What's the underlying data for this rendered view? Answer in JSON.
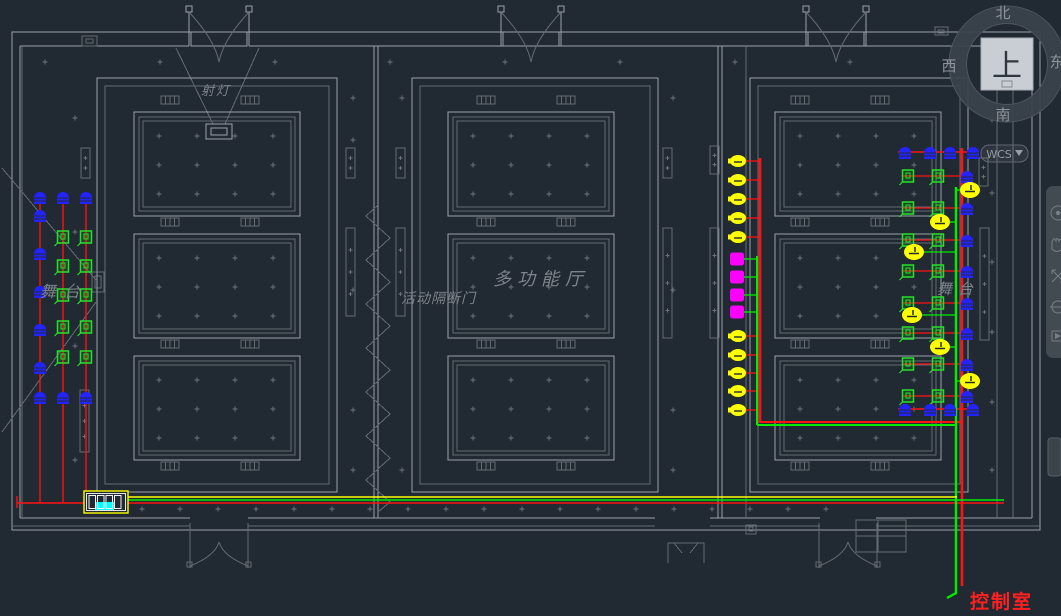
{
  "colors": {
    "background": "#212933",
    "line": "#9aa1a8",
    "line_dim": "#646b72",
    "text": "#7d848b",
    "wire_red": "#ff1212",
    "wire_green": "#00ef00",
    "wire_yellow": "#ffff00",
    "device_blue": "#2323ff",
    "device_green": "#28e028",
    "device_yellow": "#ffff00",
    "device_magenta": "#ff00ff",
    "rack_cyan": "#00ffff",
    "control_room_text": "#ff2020"
  },
  "viewcube": {
    "north": "北",
    "south": "南",
    "west": "西",
    "east": "东",
    "top": "上",
    "wcs_label": "WCS"
  },
  "drawing": {
    "labels": [
      {
        "id": "spotlight",
        "text": "射灯",
        "x": 201,
        "y": 95,
        "size": 13,
        "ls": 2
      },
      {
        "id": "stage-left",
        "text": "舞台",
        "x": 40,
        "y": 297,
        "size": 16,
        "ls": 8
      },
      {
        "id": "partition-door",
        "text": "活动隔断门",
        "x": 401,
        "y": 303,
        "size": 14,
        "ls": 1
      },
      {
        "id": "hall",
        "text": "多功能厅",
        "x": 493,
        "y": 285,
        "size": 18,
        "ls": 6
      },
      {
        "id": "stage-right",
        "text": "舞台",
        "x": 937,
        "y": 294,
        "size": 15,
        "ls": 6
      },
      {
        "id": "control-room",
        "text": "控制室",
        "x": 970,
        "y": 608,
        "size": 19,
        "ls": 2,
        "color": "#ff2020",
        "bold": true
      }
    ],
    "rack": {
      "x": 84,
      "y": 491,
      "w": 44,
      "h": 22
    },
    "devices": [
      {
        "t": "blue",
        "x": 40,
        "y": 197
      },
      {
        "t": "blue",
        "x": 63,
        "y": 197
      },
      {
        "t": "blue",
        "x": 86,
        "y": 197
      },
      {
        "t": "blue",
        "x": 40,
        "y": 215
      },
      {
        "t": "blue",
        "x": 40,
        "y": 253
      },
      {
        "t": "blue",
        "x": 40,
        "y": 291
      },
      {
        "t": "blue",
        "x": 40,
        "y": 329
      },
      {
        "t": "blue",
        "x": 40,
        "y": 367
      },
      {
        "t": "blue",
        "x": 40,
        "y": 397
      },
      {
        "t": "blue",
        "x": 63,
        "y": 397
      },
      {
        "t": "blue",
        "x": 86,
        "y": 397
      },
      {
        "t": "green",
        "x": 63,
        "y": 237
      },
      {
        "t": "green",
        "x": 86,
        "y": 237
      },
      {
        "t": "green",
        "x": 63,
        "y": 266
      },
      {
        "t": "green",
        "x": 86,
        "y": 266
      },
      {
        "t": "green",
        "x": 63,
        "y": 295
      },
      {
        "t": "green",
        "x": 86,
        "y": 295
      },
      {
        "t": "green",
        "x": 63,
        "y": 327
      },
      {
        "t": "green",
        "x": 86,
        "y": 327
      },
      {
        "t": "green",
        "x": 63,
        "y": 357
      },
      {
        "t": "green",
        "x": 86,
        "y": 357
      },
      {
        "t": "yellow",
        "x": 738,
        "y": 161
      },
      {
        "t": "yellow",
        "x": 738,
        "y": 180
      },
      {
        "t": "yellow",
        "x": 738,
        "y": 199
      },
      {
        "t": "yellow",
        "x": 738,
        "y": 218
      },
      {
        "t": "yellow",
        "x": 738,
        "y": 237
      },
      {
        "t": "magenta",
        "x": 737,
        "y": 259
      },
      {
        "t": "magenta",
        "x": 737,
        "y": 277
      },
      {
        "t": "magenta",
        "x": 737,
        "y": 295
      },
      {
        "t": "magenta",
        "x": 737,
        "y": 312
      },
      {
        "t": "yellow",
        "x": 738,
        "y": 336
      },
      {
        "t": "yellow",
        "x": 738,
        "y": 355
      },
      {
        "t": "yellow",
        "x": 738,
        "y": 373
      },
      {
        "t": "yellow",
        "x": 738,
        "y": 391
      },
      {
        "t": "yellow",
        "x": 738,
        "y": 410
      },
      {
        "t": "blue",
        "x": 905,
        "y": 152
      },
      {
        "t": "blue",
        "x": 930,
        "y": 152
      },
      {
        "t": "blue",
        "x": 950,
        "y": 152
      },
      {
        "t": "blue",
        "x": 973,
        "y": 152
      },
      {
        "t": "green",
        "x": 908,
        "y": 176
      },
      {
        "t": "green",
        "x": 938,
        "y": 176
      },
      {
        "t": "blue",
        "x": 967,
        "y": 176
      },
      {
        "t": "green",
        "x": 908,
        "y": 208
      },
      {
        "t": "green",
        "x": 938,
        "y": 208
      },
      {
        "t": "blue",
        "x": 967,
        "y": 208
      },
      {
        "t": "green",
        "x": 908,
        "y": 240
      },
      {
        "t": "green",
        "x": 938,
        "y": 240
      },
      {
        "t": "blue",
        "x": 967,
        "y": 240
      },
      {
        "t": "green",
        "x": 908,
        "y": 271
      },
      {
        "t": "green",
        "x": 938,
        "y": 271
      },
      {
        "t": "blue",
        "x": 967,
        "y": 271
      },
      {
        "t": "green",
        "x": 908,
        "y": 303
      },
      {
        "t": "green",
        "x": 938,
        "y": 303
      },
      {
        "t": "blue",
        "x": 967,
        "y": 303
      },
      {
        "t": "green",
        "x": 908,
        "y": 333
      },
      {
        "t": "green",
        "x": 938,
        "y": 333
      },
      {
        "t": "blue",
        "x": 967,
        "y": 333
      },
      {
        "t": "green",
        "x": 908,
        "y": 364
      },
      {
        "t": "green",
        "x": 938,
        "y": 364
      },
      {
        "t": "blue",
        "x": 967,
        "y": 364
      },
      {
        "t": "green",
        "x": 908,
        "y": 396
      },
      {
        "t": "green",
        "x": 938,
        "y": 396
      },
      {
        "t": "blue",
        "x": 967,
        "y": 396
      },
      {
        "t": "yellow-hl",
        "x": 970,
        "y": 190
      },
      {
        "t": "yellow-hl",
        "x": 940,
        "y": 222
      },
      {
        "t": "yellow-hl",
        "x": 914,
        "y": 252
      },
      {
        "t": "yellow-hl",
        "x": 912,
        "y": 315
      },
      {
        "t": "yellow-hl",
        "x": 940,
        "y": 347
      },
      {
        "t": "yellow-hl",
        "x": 970,
        "y": 381
      },
      {
        "t": "blue",
        "x": 905,
        "y": 409
      },
      {
        "t": "blue",
        "x": 930,
        "y": 409
      },
      {
        "t": "blue",
        "x": 950,
        "y": 409
      },
      {
        "t": "blue",
        "x": 973,
        "y": 409
      }
    ],
    "wires": [
      {
        "c": "red",
        "w": 1.4,
        "p": [
          [
            40,
            192
          ],
          [
            40,
            503
          ]
        ]
      },
      {
        "c": "red",
        "w": 1.4,
        "p": [
          [
            63,
            192
          ],
          [
            63,
            503
          ]
        ]
      },
      {
        "c": "red",
        "w": 1.4,
        "p": [
          [
            86,
            192
          ],
          [
            86,
            503
          ]
        ]
      },
      {
        "c": "red",
        "w": 1.4,
        "p": [
          [
            17,
            496
          ],
          [
            17,
            508
          ]
        ]
      },
      {
        "c": "red",
        "w": 1.6,
        "p": [
          [
            17,
            503
          ],
          [
            1004,
            503
          ]
        ]
      },
      {
        "c": "red",
        "w": 1.3,
        "p": [
          [
            744,
            161
          ],
          [
            761,
            161
          ]
        ]
      },
      {
        "c": "red",
        "w": 1.3,
        "p": [
          [
            744,
            180
          ],
          [
            761,
            180
          ]
        ]
      },
      {
        "c": "red",
        "w": 1.3,
        "p": [
          [
            744,
            199
          ],
          [
            761,
            199
          ]
        ]
      },
      {
        "c": "red",
        "w": 1.3,
        "p": [
          [
            744,
            218
          ],
          [
            761,
            218
          ]
        ]
      },
      {
        "c": "red",
        "w": 1.3,
        "p": [
          [
            744,
            237
          ],
          [
            761,
            237
          ]
        ]
      },
      {
        "c": "red",
        "w": 1.3,
        "p": [
          [
            744,
            336
          ],
          [
            761,
            336
          ]
        ]
      },
      {
        "c": "red",
        "w": 1.3,
        "p": [
          [
            744,
            355
          ],
          [
            761,
            355
          ]
        ]
      },
      {
        "c": "red",
        "w": 1.3,
        "p": [
          [
            744,
            373
          ],
          [
            761,
            373
          ]
        ]
      },
      {
        "c": "red",
        "w": 1.3,
        "p": [
          [
            744,
            391
          ],
          [
            761,
            391
          ]
        ]
      },
      {
        "c": "red",
        "w": 1.3,
        "p": [
          [
            744,
            410
          ],
          [
            761,
            410
          ]
        ]
      },
      {
        "c": "red",
        "w": 2.6,
        "p": [
          [
            760,
            158
          ],
          [
            760,
            423
          ]
        ]
      },
      {
        "c": "red",
        "w": 2.0,
        "p": [
          [
            760,
            422
          ],
          [
            963,
            422
          ]
        ]
      },
      {
        "c": "red",
        "w": 1.4,
        "p": [
          [
            898,
            152
          ],
          [
            976,
            152
          ]
        ]
      },
      {
        "c": "red",
        "w": 1.4,
        "p": [
          [
            898,
            409
          ],
          [
            976,
            409
          ]
        ]
      },
      {
        "c": "red",
        "w": 1.2,
        "p": [
          [
            902,
            176
          ],
          [
            973,
            176
          ]
        ]
      },
      {
        "c": "red",
        "w": 1.2,
        "p": [
          [
            902,
            208
          ],
          [
            973,
            208
          ]
        ]
      },
      {
        "c": "red",
        "w": 1.2,
        "p": [
          [
            902,
            240
          ],
          [
            973,
            240
          ]
        ]
      },
      {
        "c": "red",
        "w": 1.2,
        "p": [
          [
            902,
            271
          ],
          [
            973,
            271
          ]
        ]
      },
      {
        "c": "red",
        "w": 1.2,
        "p": [
          [
            902,
            303
          ],
          [
            973,
            303
          ]
        ]
      },
      {
        "c": "red",
        "w": 1.2,
        "p": [
          [
            902,
            333
          ],
          [
            973,
            333
          ]
        ]
      },
      {
        "c": "red",
        "w": 1.2,
        "p": [
          [
            902,
            364
          ],
          [
            973,
            364
          ]
        ]
      },
      {
        "c": "red",
        "w": 1.2,
        "p": [
          [
            902,
            396
          ],
          [
            973,
            396
          ]
        ]
      },
      {
        "c": "red",
        "w": 2.6,
        "p": [
          [
            962,
            148
          ],
          [
            962,
            586
          ]
        ]
      },
      {
        "c": "green",
        "w": 1.3,
        "p": [
          [
            744,
            259
          ],
          [
            758,
            259
          ]
        ]
      },
      {
        "c": "green",
        "w": 1.3,
        "p": [
          [
            744,
            277
          ],
          [
            758,
            277
          ]
        ]
      },
      {
        "c": "green",
        "w": 1.3,
        "p": [
          [
            744,
            295
          ],
          [
            758,
            295
          ]
        ]
      },
      {
        "c": "green",
        "w": 1.3,
        "p": [
          [
            744,
            312
          ],
          [
            758,
            312
          ]
        ]
      },
      {
        "c": "green",
        "w": 2.0,
        "p": [
          [
            757,
            256
          ],
          [
            757,
            425
          ]
        ]
      },
      {
        "c": "green",
        "w": 2.0,
        "p": [
          [
            757,
            425
          ],
          [
            957,
            425
          ]
        ]
      },
      {
        "c": "green",
        "w": 2.4,
        "p": [
          [
            956,
            187
          ],
          [
            956,
            593
          ],
          [
            947,
            598
          ]
        ]
      },
      {
        "c": "green",
        "w": 1.3,
        "p": [
          [
            956,
            190
          ],
          [
            963,
            190
          ]
        ]
      },
      {
        "c": "green",
        "w": 1.3,
        "p": [
          [
            947,
            222
          ],
          [
            956,
            222
          ]
        ]
      },
      {
        "c": "green",
        "w": 1.3,
        "p": [
          [
            921,
            252
          ],
          [
            956,
            252
          ]
        ]
      },
      {
        "c": "green",
        "w": 1.3,
        "p": [
          [
            919,
            315
          ],
          [
            956,
            315
          ]
        ]
      },
      {
        "c": "green",
        "w": 1.3,
        "p": [
          [
            947,
            347
          ],
          [
            956,
            347
          ]
        ]
      },
      {
        "c": "green",
        "w": 1.3,
        "p": [
          [
            956,
            381
          ],
          [
            963,
            381
          ]
        ]
      },
      {
        "c": "green",
        "w": 1.6,
        "p": [
          [
            128,
            500
          ],
          [
            1004,
            500
          ]
        ]
      },
      {
        "c": "yellow",
        "w": 1.4,
        "p": [
          [
            128,
            497
          ],
          [
            957,
            497
          ]
        ]
      }
    ]
  },
  "navbar": {
    "icons": [
      "navigation-wheel",
      "pan",
      "zoom",
      "orbit",
      "showmotion"
    ]
  }
}
